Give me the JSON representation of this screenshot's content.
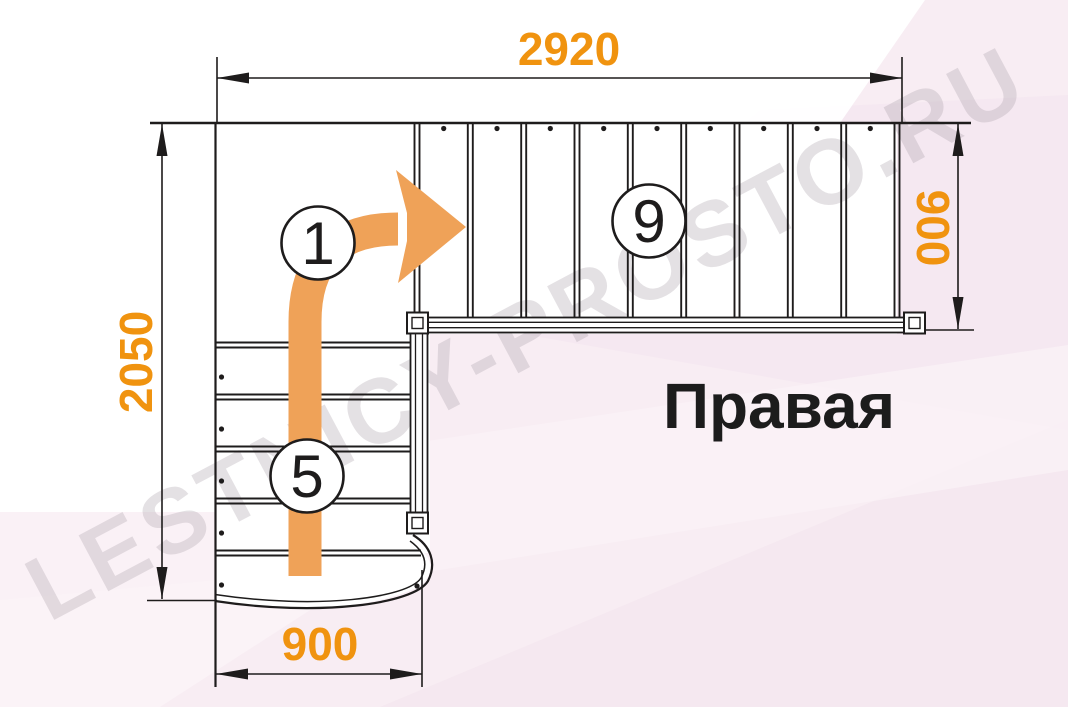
{
  "diagram": {
    "title": "Правая",
    "watermark": "LESTNICY-PROSTO.RU",
    "dimensions": {
      "top_width": "2920",
      "left_height": "2050",
      "right_depth": "900",
      "bottom_width": "900"
    },
    "markers": {
      "start_step": "1",
      "lower_flight_steps": "5",
      "upper_flight_steps": "9"
    }
  },
  "colors": {
    "dimension_text": "#f0930f",
    "arrow": "#efa258",
    "line": "#1e1c1c",
    "watermark": "#a99fa8",
    "background": "#f8edf3",
    "paper": "#ffffff",
    "title_text": "#1c1c1c"
  }
}
